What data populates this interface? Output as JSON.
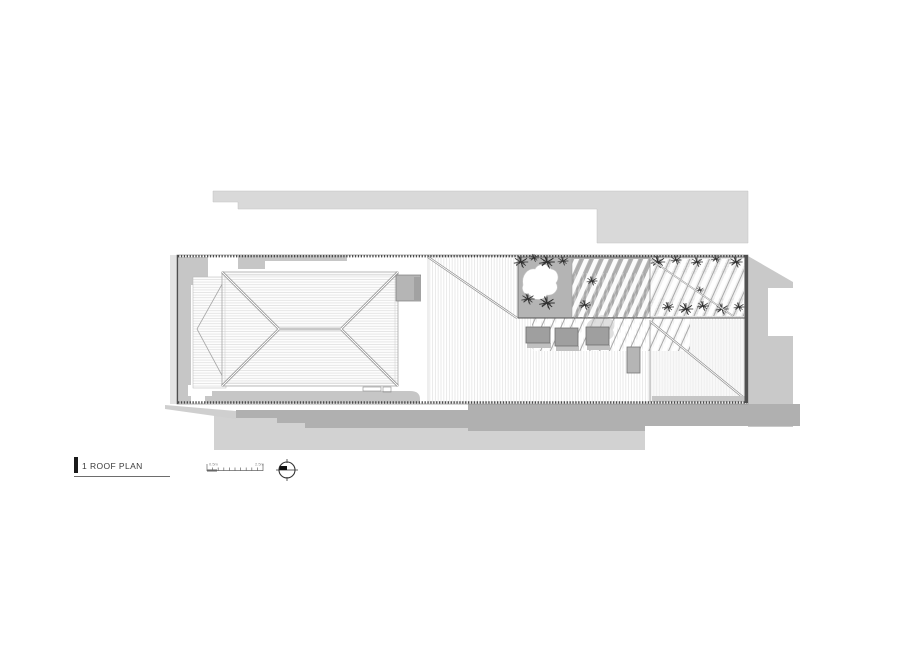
{
  "titleblock": {
    "drawing_number": "1",
    "drawing_title": "ROOF PLAN",
    "scale_bar": {
      "start_label": "0.5m",
      "end_label": "2.5m"
    }
  },
  "plan": {
    "type": "architectural-roof-plan",
    "elements": [
      "neighbour-footprint",
      "hip-roof",
      "verandah-roof",
      "metal-deck-roof",
      "roof-courtyard",
      "tree-canopy",
      "pergola",
      "green-roof",
      "skylights",
      "roof-hatch",
      "chimney",
      "cast-shadows"
    ],
    "colors": {
      "background": "#ffffff",
      "site_gray": "#d9d9d9",
      "shadow_gray": "#c9c9c9",
      "shadow_dark": "#b0b0b0",
      "band_gray": "#c6c6c6",
      "courtyard_gray": "#b4b4b4",
      "outline_dark": "#4a4a4a",
      "hatch_light": "#dcdcdc"
    }
  }
}
